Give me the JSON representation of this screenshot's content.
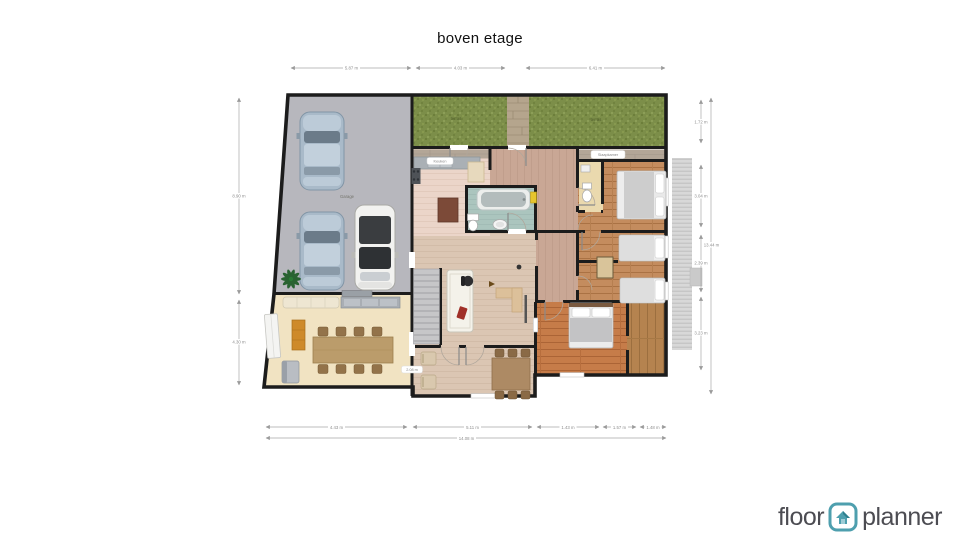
{
  "title": "boven etage",
  "logo": {
    "floor": "floor",
    "planner": "planner"
  },
  "labels": {
    "garage": "Garage",
    "terrace_left": "terras",
    "terrace_right": "terras",
    "kitchen": "Keuken",
    "bedroom": "Slaapkamer"
  },
  "dimensions": {
    "top": [
      "5.87 m",
      "4.03 m",
      "6.41 m"
    ],
    "left": [
      "8.90 m",
      "4.30 m"
    ],
    "right": [
      "1.72 m",
      "3.04 m",
      "2.39 m",
      "3.23 m"
    ],
    "right_total": "13.44 m",
    "bottom": [
      "4.43 m",
      "5.11 m",
      "1.43 m",
      "1.57 m",
      "1.48 m"
    ],
    "bottom_total": "14.08 m",
    "wall_chip": "2.08 m"
  },
  "colors": {
    "wall": "#1a1a1a",
    "garage_floor": "#b7b7bd",
    "grass": "#7c8e49",
    "kitchen_floor": "#ebd5c9",
    "living_floor": "#dbc6b3",
    "hall_floor": "#c9a795",
    "bathroom_floor": "#abc5be",
    "toilet_floor": "#ead9ae",
    "bedroom_wood": "#c48c5e",
    "bedroom_wood_dark": "#c67c49",
    "dining_floor": "#f1e3c2",
    "boiler_yellow": "#e6c52e",
    "logo_teal": "#4e9fae"
  }
}
